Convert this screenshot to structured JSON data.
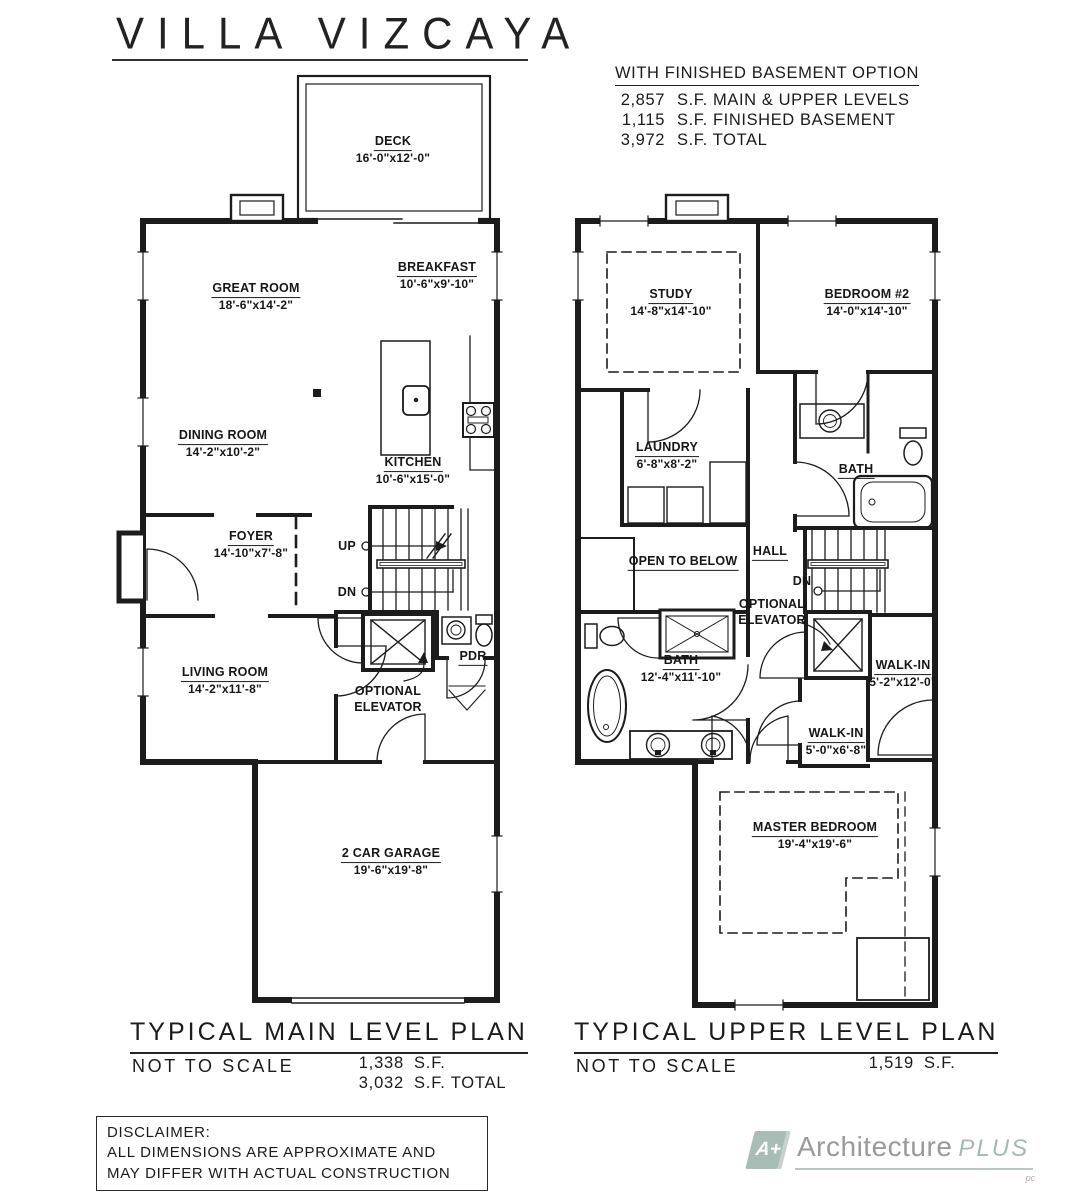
{
  "title": "VILLA VIZCAYA",
  "basement_option": {
    "heading": "WITH FINISHED BASEMENT OPTION",
    "rows": [
      {
        "value": "2,857",
        "label": "S.F. MAIN & UPPER LEVELS"
      },
      {
        "value": "1,115",
        "label": "S.F. FINISHED BASEMENT"
      },
      {
        "value": "3,972",
        "label": "S.F. TOTAL"
      }
    ]
  },
  "main_plan": {
    "title": "TYPICAL MAIN LEVEL PLAN",
    "scale_note": "NOT TO SCALE",
    "area_rows": [
      {
        "value": "1,338",
        "label": "S.F."
      },
      {
        "value": "3,032",
        "label": "S.F. TOTAL"
      }
    ],
    "rooms": {
      "deck": {
        "name": "DECK",
        "dims": "16'-0\"x12'-0\""
      },
      "great_room": {
        "name": "GREAT ROOM",
        "dims": "18'-6\"x14'-2\""
      },
      "breakfast": {
        "name": "BREAKFAST",
        "dims": "10'-6\"x9'-10\""
      },
      "dining_room": {
        "name": "DINING ROOM",
        "dims": "14'-2\"x10'-2\""
      },
      "kitchen": {
        "name": "KITCHEN",
        "dims": "10'-6\"x15'-0\""
      },
      "foyer": {
        "name": "FOYER",
        "dims": "14'-10\"x7'-8\""
      },
      "living_room": {
        "name": "LIVING ROOM",
        "dims": "14'-2\"x11'-8\""
      },
      "garage": {
        "name": "2 CAR GARAGE",
        "dims": "19'-6\"x19'-8\""
      },
      "pdr": {
        "name": "PDR"
      }
    },
    "annotations": {
      "up": "UP",
      "dn": "DN",
      "optional_elevator_line1": "OPTIONAL",
      "optional_elevator_line2": "ELEVATOR"
    }
  },
  "upper_plan": {
    "title": "TYPICAL UPPER LEVEL PLAN",
    "scale_note": "NOT TO SCALE",
    "area_rows": [
      {
        "value": "1,519",
        "label": "S.F."
      }
    ],
    "rooms": {
      "study": {
        "name": "STUDY",
        "dims": "14'-8\"x14'-10\""
      },
      "bedroom2": {
        "name": "BEDROOM #2",
        "dims": "14'-0\"x14'-10\""
      },
      "laundry": {
        "name": "LAUNDRY",
        "dims": "6'-8\"x8'-2\""
      },
      "bath_upper": {
        "name": "BATH"
      },
      "hall": {
        "name": "HALL"
      },
      "open_to_below": {
        "name": "OPEN TO BELOW"
      },
      "master_bath": {
        "name": "BATH",
        "dims": "12'-4\"x11'-10\""
      },
      "walkin_large": {
        "name": "WALK-IN",
        "dims": "5'-2\"x12'-0\""
      },
      "walkin_small": {
        "name": "WALK-IN",
        "dims": "5'-0\"x6'-8\""
      },
      "master_bedroom": {
        "name": "MASTER BEDROOM",
        "dims": "19'-4\"x19'-6\""
      }
    },
    "annotations": {
      "dn": "DN",
      "optional_elevator_line1": "OPTIONAL",
      "optional_elevator_line2": "ELEVATOR"
    }
  },
  "disclaimer": {
    "title": "DISCLAIMER:",
    "line1": "ALL DIMENSIONS ARE APPROXIMATE AND",
    "line2": "MAY DIFFER WITH ACTUAL CONSTRUCTION"
  },
  "logo": {
    "mark": "A+",
    "name": "Architecture",
    "plus": "PLUS",
    "suffix": "pc",
    "mark_color": "#a9bdb7",
    "name_color": "#9a9a9a",
    "plus_color": "#a5b9b3"
  },
  "ink_color": "#1c1c1c"
}
